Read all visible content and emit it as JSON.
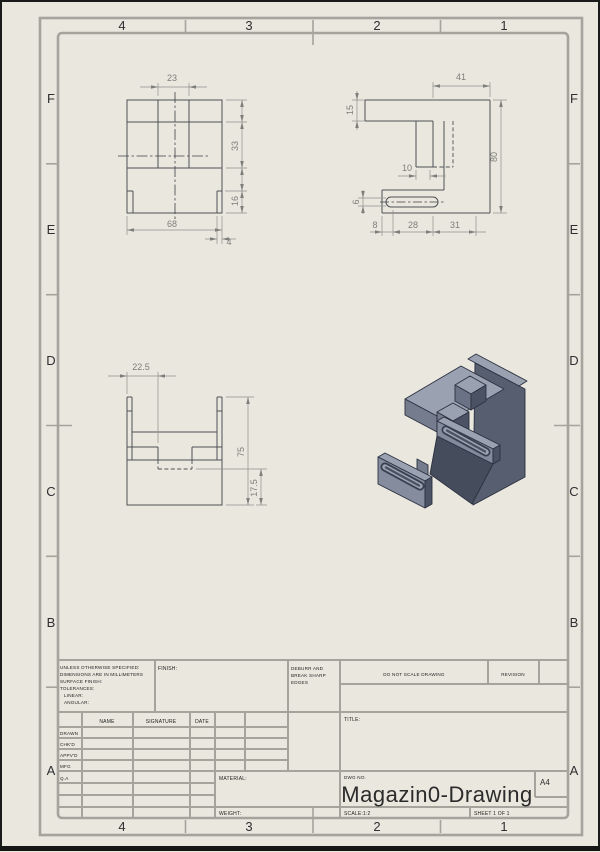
{
  "sheet": {
    "columns": [
      "4",
      "3",
      "2",
      "1"
    ],
    "rows": [
      "F",
      "E",
      "D",
      "C",
      "B",
      "A"
    ]
  },
  "dims": {
    "front": {
      "w23": "23",
      "h33": "33",
      "h16": "16",
      "w68": "68",
      "w4": "4"
    },
    "side": {
      "w41": "41",
      "h15": "15",
      "w10": "10",
      "h6": "6",
      "w8": "8",
      "w28": "28",
      "w31": "31",
      "h80": "80"
    },
    "top": {
      "w225": "22.5",
      "h75": "75",
      "h175": "17.5"
    }
  },
  "title_block": {
    "spec_lines": [
      "UNLESS OTHERWISE SPECIFIED:",
      "DIMENSIONS ARE IN MILLIMETERS",
      "SURFACE FINISH:",
      "TOLERANCES:",
      "LINEAR:",
      "ANGULAR:"
    ],
    "finish_label": "FINISH:",
    "deburr_lines": [
      "DEBURR AND",
      "BREAK SHARP",
      "EDGES"
    ],
    "do_not_scale": "DO NOT SCALE DRAWING",
    "revision_label": "REVISION",
    "title_label": "TITLE:",
    "headers": {
      "name": "NAME",
      "signature": "SIGNATURE",
      "date": "DATE"
    },
    "approval_rows": [
      "DRAWN",
      "CHK'D",
      "APPV'D",
      "MFG",
      "Q.A"
    ],
    "material_label": "MATERIAL:",
    "weight_label": "WEIGHT:",
    "dwg_label": "DWG NO.",
    "dwg_number": "Magazin0-Drawing",
    "paper_size": "A4",
    "scale_text": "SCALE:1:2",
    "sheet_text": "SHEET 1 OF 1"
  },
  "colors": {
    "paper": "#e9e7de",
    "frame": "#a5a39b",
    "drawing_line": "#4e5055",
    "dimension": "#7e7e7b",
    "part_top": "#9aa2b2",
    "part_left": "#747c8e",
    "part_right": "#565e6f",
    "part_shadow": "#454c5b"
  }
}
